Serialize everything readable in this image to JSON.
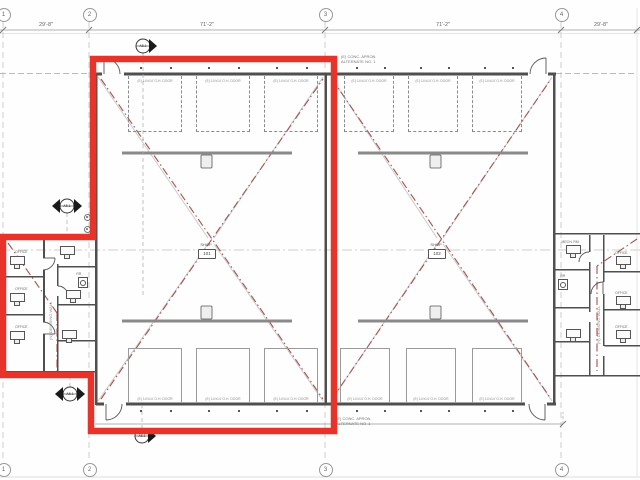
{
  "sheet": {
    "accent_red": "#e8332a",
    "demo_red": "#a85252",
    "wall_gray": "#4f4f4f",
    "line_gray": "#c4c4c4"
  },
  "grid": {
    "columns": [
      {
        "label": "1"
      },
      {
        "label": "2"
      },
      {
        "label": "3"
      },
      {
        "label": "4"
      }
    ]
  },
  "dimensions": {
    "top": [
      {
        "text": "29'-8\""
      },
      {
        "text": "71'-2\""
      },
      {
        "text": "71'-2\""
      },
      {
        "text": "29'-8\""
      }
    ]
  },
  "notes": {
    "top": [
      "(E) CONC. APRON",
      "ALTERNATE NO. 1"
    ],
    "bottom": [
      "(E) CONC. APRON",
      "ALTERNATE NO. 1"
    ]
  },
  "oh_doors": {
    "label": "(E) 14'x14' O.H. DOOR"
  },
  "bays": [
    {
      "tag_caption": "SHOP",
      "tag_number": "101"
    },
    {
      "tag_caption": "SHOP",
      "tag_number": "102"
    }
  ],
  "markers": {
    "sheet_ref": "A5.1"
  },
  "wings": {
    "corridor_note": "(N) DEMISING WALL",
    "left_room_tags": [
      "OFFICE",
      "OFFICE",
      "OFFICE",
      "RR"
    ],
    "right_room_tags": [
      "MECH. RM",
      "RR",
      "OFFICE",
      "OFFICE",
      "OFFICE"
    ]
  }
}
